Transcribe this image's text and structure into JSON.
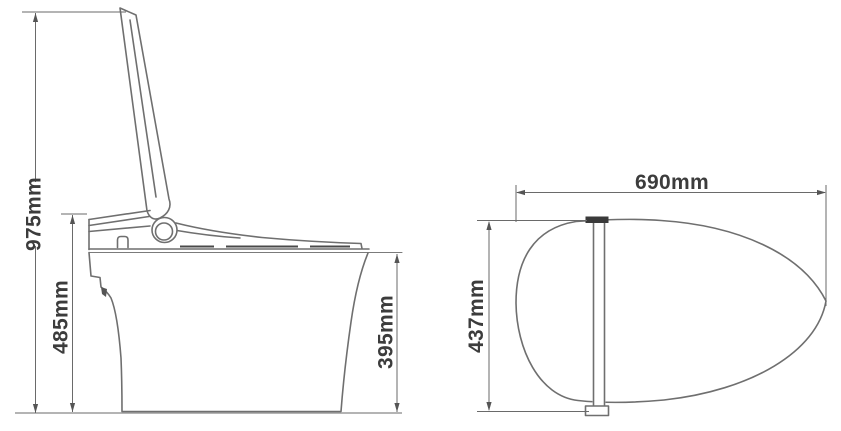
{
  "diagram": {
    "subject": "Smart toilet technical dimension drawing: side view with lid raised and top view of lid",
    "colors": {
      "background": "#ffffff",
      "outline": "#6f6f6f",
      "dimension_line": "#6a6a6a",
      "label_text": "#3c3c3c",
      "dark_detail": "#3a3a3a"
    },
    "side_view": {
      "dimensions": {
        "total_height": "975mm",
        "seat_height": "485mm",
        "bowl_height": "395mm"
      }
    },
    "top_view": {
      "dimensions": {
        "length": "690mm",
        "width": "437mm"
      }
    }
  }
}
